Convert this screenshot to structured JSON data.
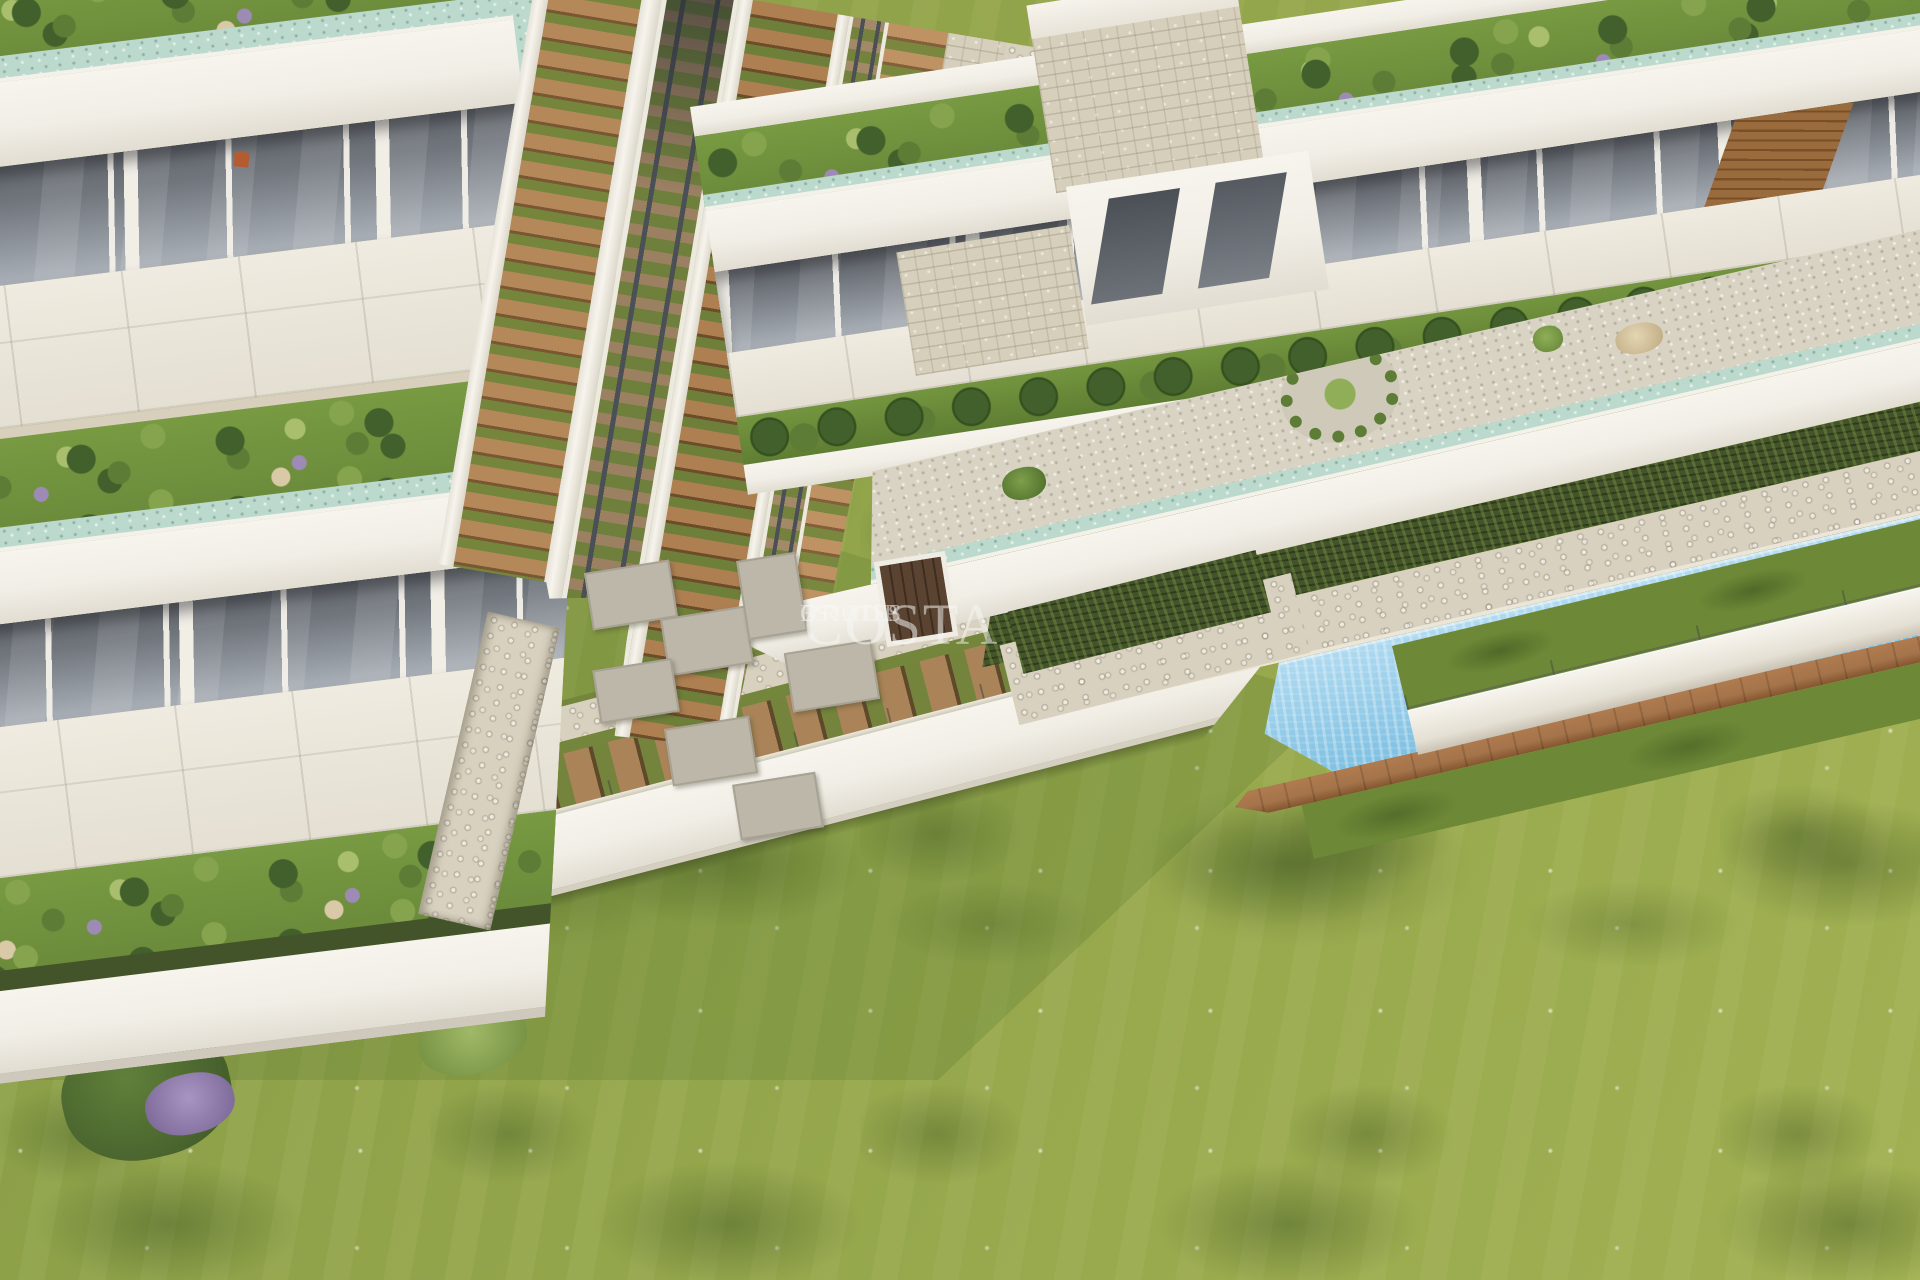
{
  "watermark": {
    "brand": "COSTA",
    "group": "GROUP",
    "estates": "ESTATES"
  },
  "colors": {
    "white-wall": "#f1eee6",
    "white-bright": "#f7f4ed",
    "terrace": "#eae6da",
    "glass-dark": "#70757c",
    "glass-light": "#aab0b7",
    "grass-roof": "#74953f",
    "grass-lawn": "#95a54b",
    "grass-dark": "#5d7531",
    "aqua": "#bcd9cd",
    "gravel": "#d9d3c4",
    "stone": "#d6cfbc",
    "cobble": "#d8d1bf",
    "hedge": "#44542a",
    "pool-light": "#aed9f0",
    "pool-deep": "#7fc0e2",
    "deck": "#a5744b",
    "wood-tread": "#b5885a",
    "rail": "#4a5056",
    "tie": "#9b8062",
    "lavender": "#9d8bb5",
    "rock": "#d9c9a6",
    "bush-dark": "#42602c",
    "bush-mid": "#5d7c36",
    "bush-light": "#86a44e",
    "bush-pale": "#a9bf6d",
    "watermark": "rgba(248,248,244,0.52)"
  }
}
